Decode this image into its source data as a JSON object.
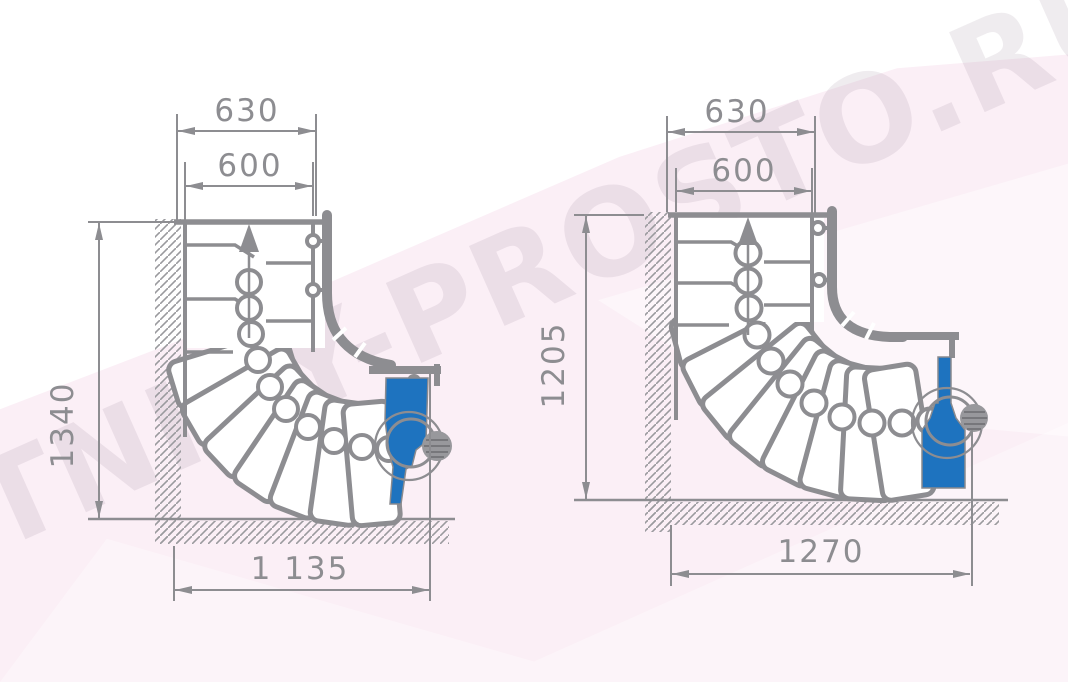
{
  "watermark": {
    "text": "LESTNICY-PROSTO.RU"
  },
  "colors": {
    "line_gray": "#8d8d91",
    "hatch_gray": "#9a9a9e",
    "newel_blue": "#1e73bf",
    "background_pink": "#fbeff6",
    "drawing_background": "#ffffff"
  },
  "diagrams": [
    {
      "name": "left-staircase-90-turn",
      "dimensions": {
        "top_outer": "630",
        "top_inner": "600",
        "height": "1340",
        "width": "1 135"
      }
    },
    {
      "name": "right-staircase-90-turn",
      "dimensions": {
        "top_outer": "630",
        "top_inner": "600",
        "height": "1205",
        "width": "1270"
      }
    }
  ]
}
